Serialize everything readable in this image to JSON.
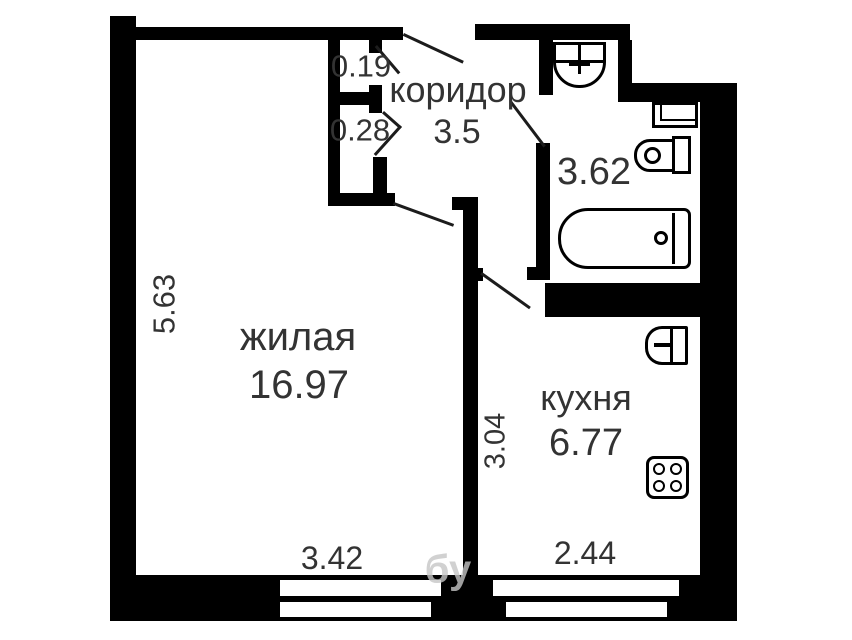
{
  "colors": {
    "wall": "#000000",
    "text": "#333333",
    "background": "#ffffff",
    "watermark": "#c6c6c6"
  },
  "plan": {
    "rooms": {
      "living": {
        "label": "жилая",
        "area": "16.97"
      },
      "corridor": {
        "label": "коридор",
        "area": "3.5"
      },
      "bathroom": {
        "area": "3.62"
      },
      "kitchen": {
        "label": "кухня",
        "area": "6.77"
      }
    },
    "dimensions": {
      "closet_depth_top": "0.19",
      "closet_depth_bottom": "0.28",
      "living_side": "5.63",
      "kitchen_side": "3.04",
      "living_width": "3.42",
      "kitchen_width": "2.44"
    },
    "fixtures": [
      "washbasin",
      "washing-machine",
      "toilet",
      "bathtub",
      "kitchen-sink",
      "stove"
    ],
    "watermark": "бу"
  }
}
